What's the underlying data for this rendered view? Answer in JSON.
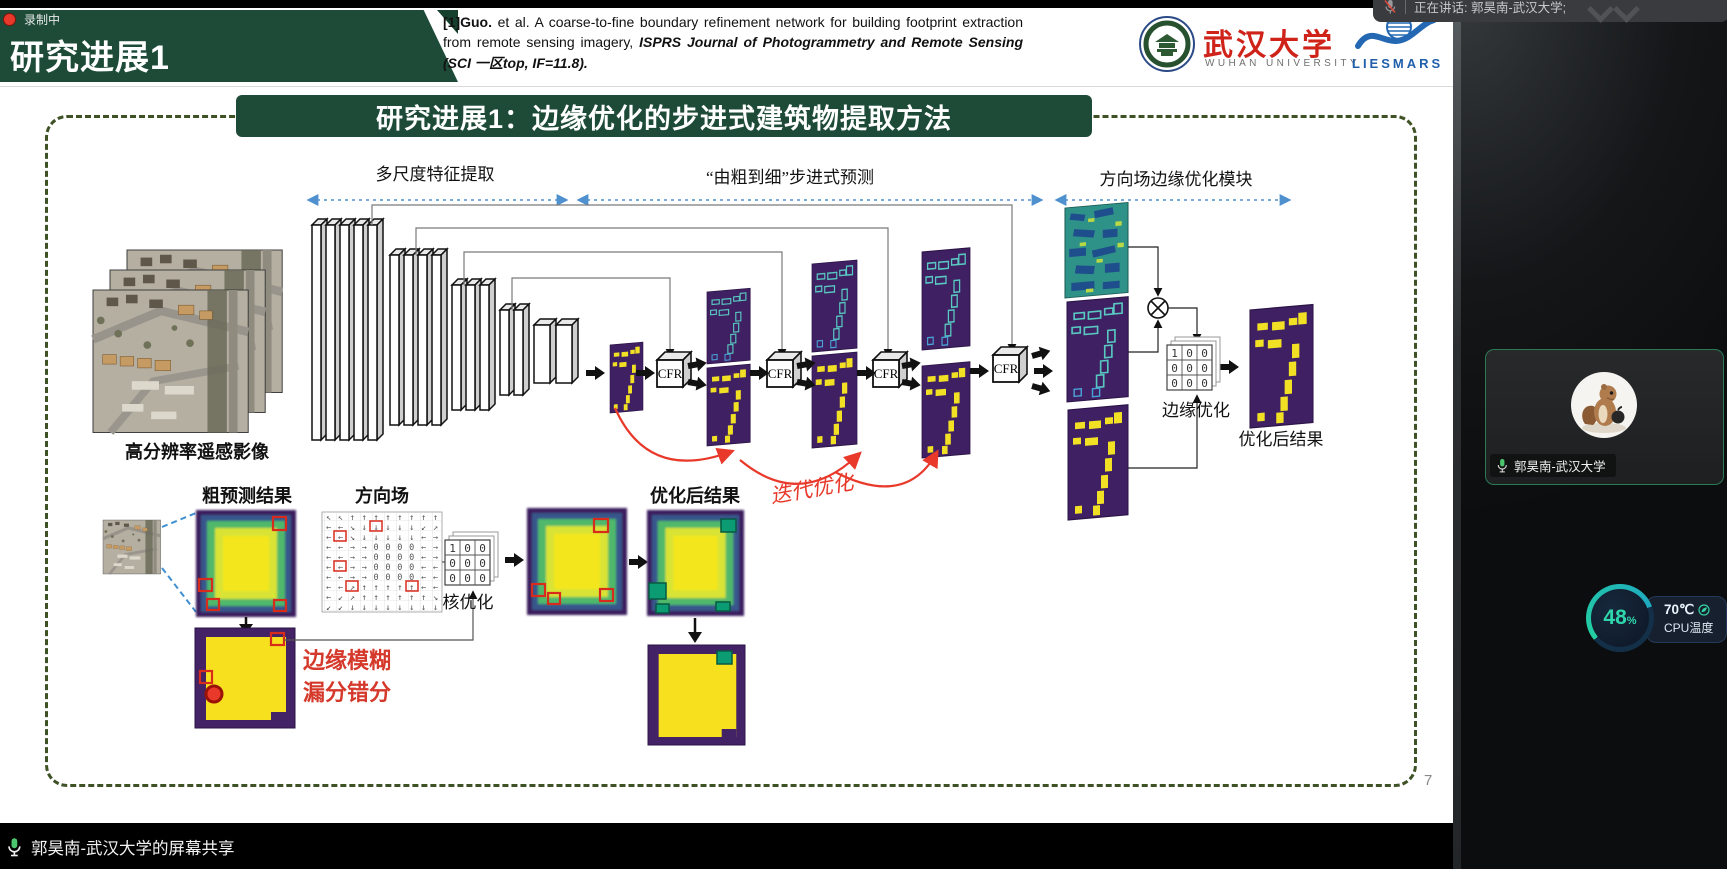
{
  "meeting": {
    "recording_label": "录制中",
    "speaking_banner": "正在讲话: 郭昊南-武汉大学;",
    "participant_name": "郭昊南-武汉大学",
    "share_banner": "郭昊南-武汉大学的屏幕共享",
    "cpu_percent": "48",
    "cpu_percent_unit": "%",
    "cpu_temp": "70℃",
    "cpu_temp_label": "CPU温度"
  },
  "header": {
    "title": "研究进展1",
    "citation_ref": "[1]Guo.",
    "citation_body": " et al. A coarse-to-fine boundary refinement network for building footprint extraction from remote sensing imagery, ",
    "citation_journal": "ISPRS Journal of Photogrammetry and Remote Sensing (SCI 一区top, IF=11.8).",
    "whu_cn": "武汉大学",
    "whu_en": "WUHAN UNIVERSITY",
    "liesmars": "LIESMARS"
  },
  "slide": {
    "title": "研究进展1：边缘优化的步进式建筑物提取方法",
    "page_number": "7",
    "sections": {
      "multiscale": "多尺度特征提取",
      "coarse2fine": "“由粗到细”步进式预测",
      "dirfield": "方向场边缘优化模块"
    },
    "labels": {
      "input": "高分辨率遥感影像",
      "cfr": "CFR",
      "iterative": "迭代优化",
      "edge_opt": "边缘优化",
      "refined_right": "优化后结果",
      "coarse": "粗预测结果",
      "dir_field": "方向场",
      "kernel_opt": "核优化",
      "refined_bottom": "优化后结果",
      "problem_line1": "边缘模糊",
      "problem_line2": "漏分错分"
    },
    "kernel": {
      "cells": [
        "1",
        "0",
        "0",
        "0",
        "0",
        "0",
        "0",
        "0",
        "0"
      ]
    },
    "direction_grid": {
      "rows": [
        "↖↖↑↑↑↑↑↑↑↑",
        "←←↘↓↓↓↓↓↙↗",
        "←←↘↓↓↓↓↓←→",
        "←←→→0000←→",
        "←←→→0000←→",
        "←←→→0000←←",
        "←←→→0000←←",
        "←←↗↑↑↑↑↑←←",
        "←↙↗↑↑↑↑↑↑↘",
        "↙↙↓↓↓↓↓↓↓↓"
      ]
    }
  },
  "colors": {
    "banner_green": "#1d4b38",
    "accent_red": "#d5392b",
    "arrow_blue": "#4f90cf",
    "viridis_purple": "#3f2163",
    "viridis_yellow": "#f2e024"
  }
}
